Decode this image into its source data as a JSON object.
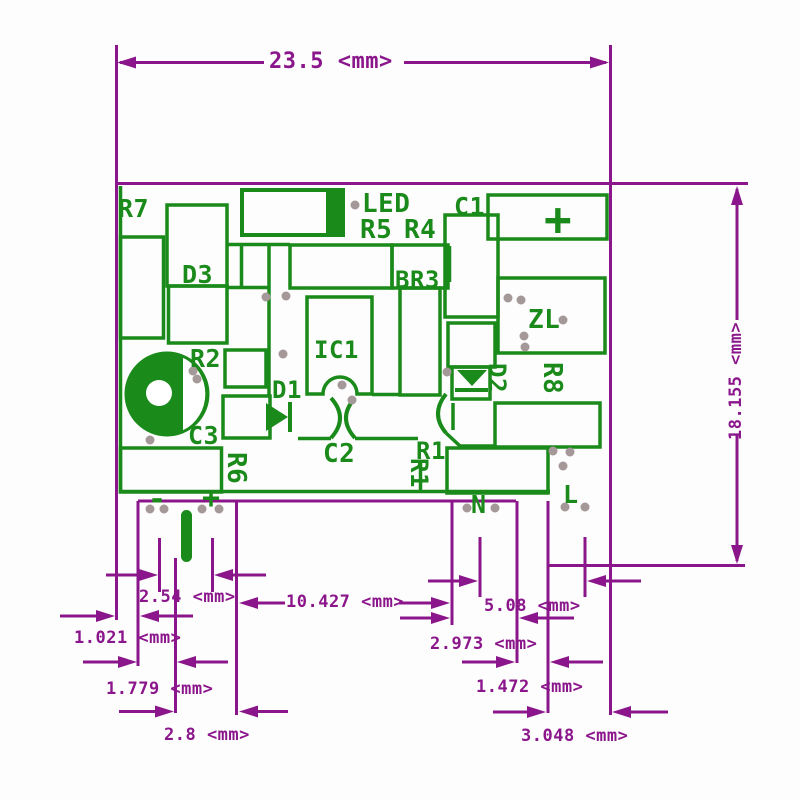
{
  "drawing_type": "pcb-dimension-diagram",
  "colors": {
    "silkscreen_green": "#1a8a1a",
    "dimension_purple": "#8b168b",
    "pad_gray": "#a59898",
    "background": "#ffffff"
  },
  "board": {
    "labels": {
      "r7": "R7",
      "d3": "D3",
      "r2": "R2",
      "c3": "C3",
      "r6": "R6",
      "d1": "D1",
      "ic1": "IC1",
      "c2": "C2",
      "r1_horizontal": "R1",
      "r1_vertical": "R1",
      "led": "LED",
      "r5": "R5",
      "r4": "R4",
      "c1": "C1",
      "br3": "BR3",
      "d2": "D2",
      "r8": "R8",
      "zl": "ZL",
      "n": "N",
      "l": "L",
      "polarity_plus_large": "+",
      "polarity_plus_pin": "+",
      "polarity_minus_pin": "-"
    }
  },
  "dimensions": {
    "total_width": "23.5 <mm>",
    "total_height": "18.155 <mm>",
    "pad_pitch_left": "2.54 <mm>",
    "pin1_width": "1.021 <mm>",
    "gap_left_inner": "1.779 <mm>",
    "gap_left_center": "2.8 <mm>",
    "center_span": "10.427 <mm>",
    "pad_pitch_right": "5.08 <mm>",
    "gap_right_outer": "2.973 <mm>",
    "pin_right_width": "1.472 <mm>",
    "gap_right_edge": "3.048 <mm>"
  }
}
